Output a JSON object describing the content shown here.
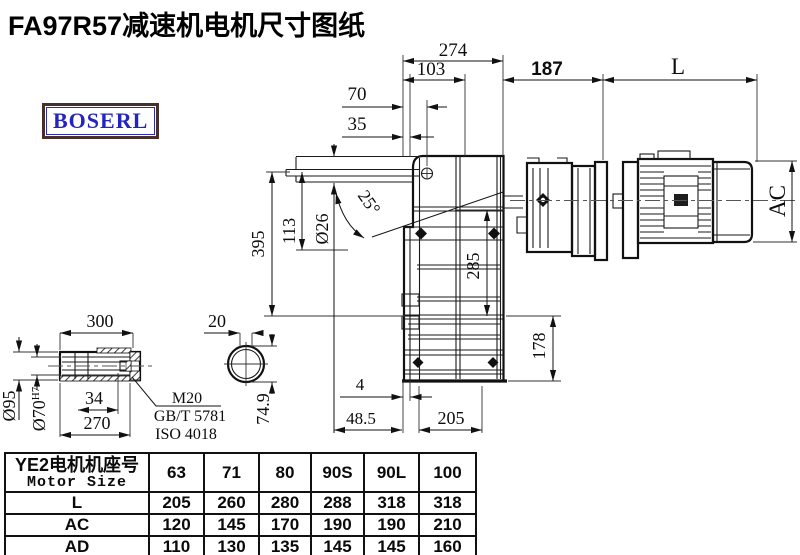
{
  "title": "FA97R57减速机电机尺寸图纸",
  "logo": {
    "text": "BOSERL"
  },
  "colors": {
    "line": "#111111",
    "logo_text": "#2424c0",
    "logo_border": "#463029",
    "table_border": "#111111"
  },
  "dims": {
    "top": {
      "w274": "274",
      "w103": "103",
      "w70": "70",
      "w35": "35",
      "w187": "187",
      "L": "L"
    },
    "main": {
      "h395": "395",
      "h113": "113",
      "dia26": "Ø26",
      "angle25": "25°",
      "h285": "285",
      "h178": "178",
      "g4": "4",
      "w48_5": "48.5",
      "w205": "205",
      "AC": "AC"
    },
    "shaft": {
      "l300": "300",
      "dia95": "Ø95",
      "dia70": "Ø70",
      "tol": "H7",
      "k34": "34",
      "l270": "270",
      "thread": "M20",
      "std1": "GB/T 5781",
      "std2": "ISO 4018"
    },
    "section": {
      "w20": "20",
      "h74_9": "74.9"
    }
  },
  "table": {
    "header_cn": "YE2电机机座号",
    "header_en": "Motor Size",
    "sizes": [
      "63",
      "71",
      "80",
      "90S",
      "90L",
      "100"
    ],
    "rows": [
      {
        "label": "L",
        "values": [
          "205",
          "260",
          "280",
          "288",
          "318",
          "318"
        ]
      },
      {
        "label": "AC",
        "values": [
          "120",
          "145",
          "170",
          "190",
          "190",
          "210"
        ]
      },
      {
        "label": "AD",
        "values": [
          "110",
          "130",
          "135",
          "145",
          "145",
          "160"
        ]
      }
    ]
  }
}
